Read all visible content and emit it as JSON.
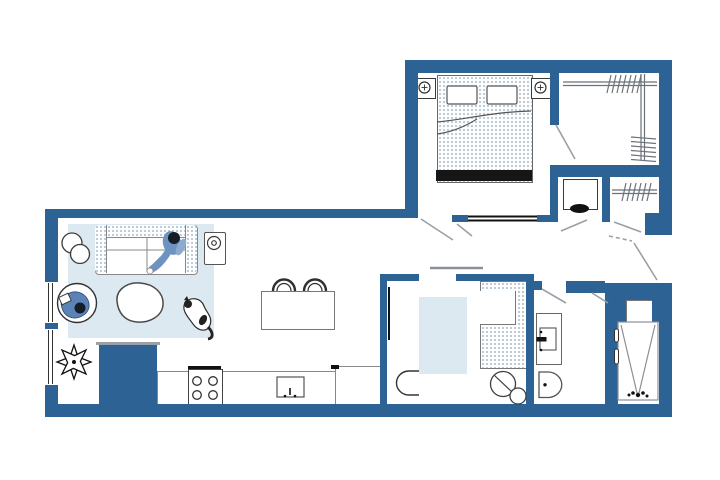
{
  "figure": {
    "type": "floor-plan",
    "label": "Apartment floor plan"
  },
  "colors": {
    "wall": "#2d6394",
    "rug": "#dce9f1",
    "stipple_dot": "#a9bccb",
    "person_accent": "#6f93c0",
    "dark_line": "#2f2f2f",
    "swing_gray": "#9aa0a6",
    "background": "#ffffff"
  },
  "rooms": {
    "bedroom": {
      "label": "Bedroom",
      "furniture": [
        "double-bed",
        "pillow",
        "pillow",
        "footboard",
        "nightstand-lamp-left",
        "nightstand-lamp-right",
        "sliding-door"
      ]
    },
    "walk_in_closet": {
      "label": "Walk-in closet",
      "furniture": [
        "hanging-rod-top",
        "hanging-rod-right"
      ]
    },
    "desk_nook": {
      "label": "Desk nook",
      "furniture": [
        "desk",
        "chair"
      ]
    },
    "hall_closet": {
      "label": "Hall closet",
      "furniture": [
        "hanging-rod"
      ]
    },
    "entry": {
      "label": "Entry",
      "furniture": [
        "entry-door"
      ]
    },
    "living_room": {
      "label": "Living room",
      "furniture": [
        "rug",
        "sofa",
        "person-on-sofa",
        "floor-lamp",
        "side-table",
        "coffee-table",
        "armchair",
        "person-in-armchair",
        "cat",
        "plant",
        "media-console"
      ]
    },
    "kitchen": {
      "label": "Kitchen",
      "furniture": [
        "counter",
        "stove",
        "sink",
        "island",
        "stool",
        "stool"
      ]
    },
    "den": {
      "label": "Den",
      "furniture": [
        "rug",
        "wardrobe",
        "chair",
        "side-stool"
      ]
    },
    "bathroom": {
      "label": "Bathroom",
      "furniture": [
        "vanity-sink",
        "toilet"
      ]
    },
    "shower_room": {
      "label": "Shower room",
      "furniture": [
        "shower-stall",
        "shelf"
      ]
    }
  }
}
